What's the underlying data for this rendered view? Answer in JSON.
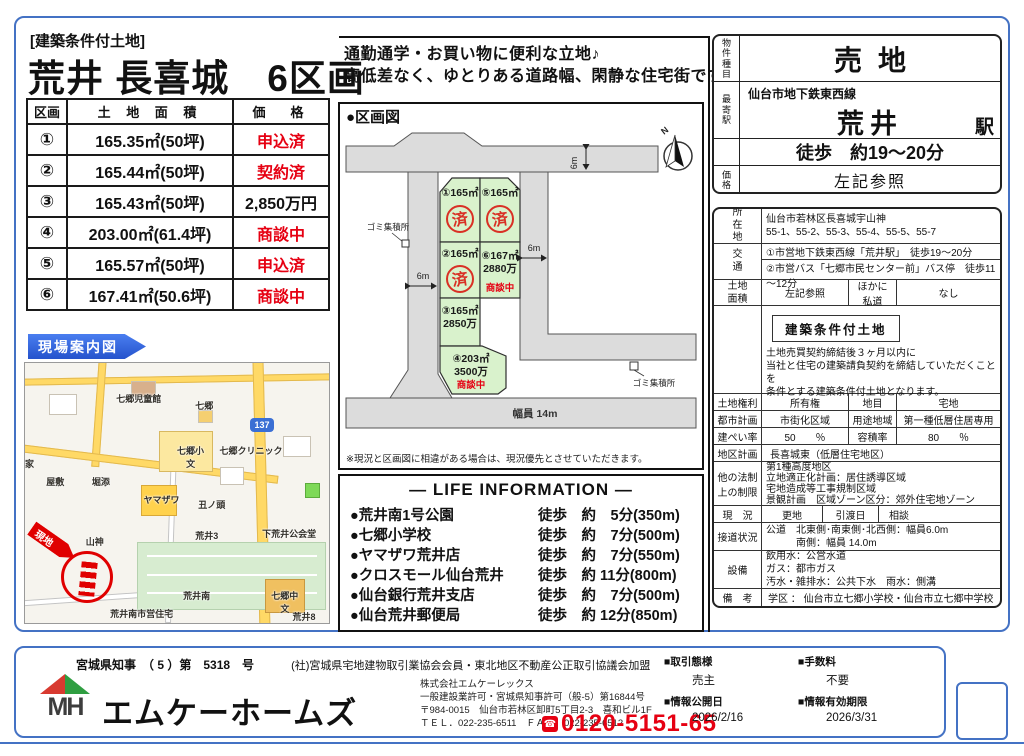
{
  "colors": {
    "accent_blue": "#4472c4",
    "banner_blue": "#2f5fd0",
    "alert_red": "#e60012",
    "lot_green": "#d9f2cc",
    "road_gray": "#dcdcdc",
    "map_road_yellow": "#ffd966"
  },
  "header": {
    "tag": "[建築条件付土地]",
    "title": "荒井 長喜城　6区画"
  },
  "catchphrase": {
    "line1": "通勤通学・お買い物に便利な立地♪",
    "line2": "高低差なく、ゆとりある道路幅、閑静な住宅街です！"
  },
  "price_table": {
    "headers": [
      "区画",
      "土 地 面 積",
      "価　格"
    ],
    "rows": [
      {
        "no": "①",
        "area": "165.35㎡(50坪)",
        "price": "申込済"
      },
      {
        "no": "②",
        "area": "165.44㎡(50坪)",
        "price": "契約済"
      },
      {
        "no": "③",
        "area": "165.43㎡(50坪)",
        "price": "2,850万円"
      },
      {
        "no": "④",
        "area": "203.00㎡(61.4坪)",
        "price": "商談中"
      },
      {
        "no": "⑤",
        "area": "165.57㎡(50坪)",
        "price": "申込済"
      },
      {
        "no": "⑥",
        "area": "167.41㎡(50.6坪)",
        "price": "商談中"
      }
    ]
  },
  "site_map": {
    "banner": "現場案内図",
    "site_label": "現地",
    "route_shield": "137",
    "labels": [
      "七郷児童館",
      "七郷",
      "七郷小",
      "文",
      "七郷クリニック",
      "屋敷",
      "堀添",
      "ヤマザワ",
      "丑ノ頭",
      "下荒井公会堂",
      "山神",
      "荒井3",
      "荒井南",
      "七郷中",
      "文",
      "荒井8",
      "荒井南市営住宅",
      "家"
    ]
  },
  "plot": {
    "title": "●区画図",
    "north_label": "N",
    "lot1_label": "①165㎡",
    "lot1_stamp": "済",
    "lot5_label": "⑤165㎡",
    "lot5_stamp": "済",
    "lot2_label": "②165㎡",
    "lot2_stamp": "済",
    "lot6_label": "⑥167㎡",
    "lot6_price": "2880万",
    "lot6_status": "商談中",
    "lot3_label": "③165㎡",
    "lot3_price": "2850万",
    "lot4_label": "④203㎡",
    "lot4_price": "3500万",
    "lot4_status": "商談中",
    "dim_top": "6m",
    "dim_left": "6m",
    "dim_right": "6m",
    "dim_bottom": "幅員 14m",
    "garbage_left": "ゴミ集積所",
    "garbage_right": "ゴミ集積所",
    "note": "※現況と区画図に相違がある場合は、現況優先とさせていただきます。"
  },
  "life_information": {
    "title": "― LIFE INFORMATION ―",
    "items": [
      {
        "name": "●荒井南1号公園",
        "dist": "徒歩　約　5分(350m)"
      },
      {
        "name": "●七郷小学校",
        "dist": "徒歩　約　7分(500m)"
      },
      {
        "name": "●ヤマザワ荒井店",
        "dist": "徒歩　約　7分(550m)"
      },
      {
        "name": "●クロスモール仙台荒井",
        "dist": "徒歩　約 11分(800m)"
      },
      {
        "name": "●仙台銀行荒井支店",
        "dist": "徒歩　約　7分(500m)"
      },
      {
        "name": "●仙台荒井郵便局",
        "dist": "徒歩　約 12分(850m)"
      }
    ]
  },
  "property": {
    "type_label": "物件種目",
    "type": "売地",
    "station_label": "最寄駅",
    "line": "仙台市地下鉄東西線",
    "station": "荒井",
    "station_unit": "駅",
    "walk": "徒歩　約19～20分",
    "price_label": "価格",
    "price": "左記参照"
  },
  "details": {
    "location_label": "所在地",
    "location1": "仙台市若林区長喜城宇山神",
    "location2": "55-1、55-2、55-3、55-4、55-5、55-7",
    "access_label": "交通",
    "access1": "①市営地下鉄東西線「荒井駅」　徒歩19～20分",
    "access2": "②市営バス「七郷市民センター前」バス停　徒歩11～12分",
    "land_area_label": "土地面積",
    "land_area": "左記参照",
    "private_road_label": "ほかに私道",
    "private_road": "なし",
    "condition_badge": "建築条件付土地",
    "condition1": "土地売買契約締結後３ヶ月以内に",
    "condition2": "当社と住宅の建築請負契約を締結していただくことを",
    "condition3": "条件とする建築条件付土地となります。",
    "rights_label": "土地権利",
    "rights": "所有権",
    "category_label": "地目",
    "category": "宅地",
    "city_plan_label": "都市計画",
    "city_plan": "市街化区域",
    "zoning_label": "用途地域",
    "zoning": "第一種低層住居専用",
    "bcr_label": "建ぺい率",
    "bcr": "50　　％",
    "far_label": "容積率",
    "far": "80　　％",
    "district_label": "地区計画",
    "district": "長喜城東（低層住宅地区）",
    "other_law_label": "他の法制上の制限",
    "law1": "第1種高度地区",
    "law2": "立地適正化計画：居住誘導区域",
    "law3": "宅地造成等工事規制区域",
    "law4": "景観計画　区域ゾーン区分：郊外住宅地ゾーン",
    "status_label": "現　況",
    "status": "更地",
    "handover_label": "引渡日",
    "handover": "相談",
    "road_label": "接道状況",
    "road1": "公道　北東側･南東側･北西側：幅員6.0m",
    "road2": "　　　南側：幅員 14.0m",
    "utility_label": "設備",
    "utility1": "飲用水：公営水道",
    "utility2": "ガス：都市ガス",
    "utility3": "汚水・雑排水：公共下水　雨水：側溝",
    "remarks_label": "備　考",
    "remarks": "学区 ： 仙台市立七郷小学校・仙台市立七郷中学校"
  },
  "footer": {
    "license": "宮城県知事　（ 5 ）第　5318　号",
    "membership": "(社)宮城県宅地建物取引業協会会員・東北地区不動産公正取引協議会加盟",
    "logo_letters": "MH",
    "brand": "エムケーホームズ",
    "company": "株式会社エムケーレックス",
    "permit": "一般建設業許可・宮城県知事許可（般-5）第16844号",
    "address": "〒984-0015　仙台市若林区卸町5丁目2-3　喜和ビル1F",
    "telfax": "ＴＥＬ．022-235-6511　ＦＡＸ．022-235-6512",
    "freedial_icon": "☎",
    "phone": "0120-5151-65",
    "deal_label": "■取引態様",
    "deal": "売主",
    "fee_label": "■手数料",
    "fee": "不要",
    "pub_label": "■情報公開日",
    "pub": "2026/2/16",
    "exp_label": "■情報有効期限",
    "exp": "2026/3/31"
  }
}
